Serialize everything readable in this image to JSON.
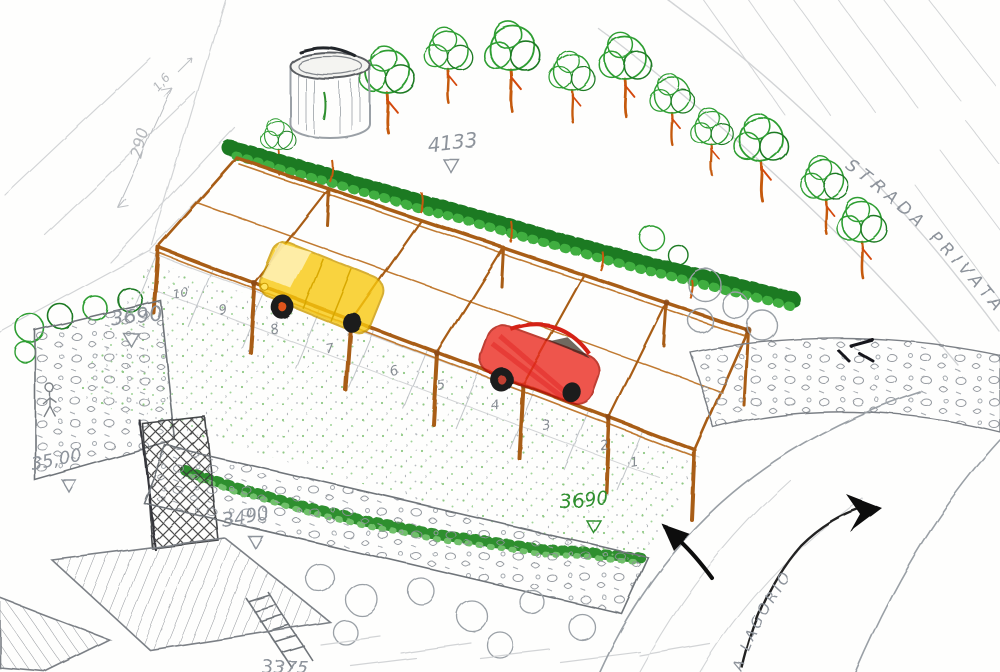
{
  "roads": {
    "strada_privata": "STRADA PRIVATA",
    "via_lagorio": "A LAGORIO"
  },
  "elevations": {
    "orchard": "4133",
    "terrace_upper": "3690",
    "wall_left": "35,00",
    "terrace_lower": "3490",
    "lawn_green": "3690",
    "bottom_partial": "3375"
  },
  "dimensions": {
    "slope_height": "290",
    "slope_offset": "1,6"
  },
  "parking_spaces": {
    "numbers": [
      "10",
      "9",
      "8",
      "7",
      "6",
      "5",
      "4",
      "3",
      "2",
      "1"
    ]
  },
  "colors": {
    "paper": "#fefefd",
    "pencil": "#9aa0a6",
    "pergola_wood": "#a85d16",
    "car_yellow": "#f6c81a",
    "car_red": "#e0251b",
    "foliage_green": "#2f9e33",
    "hedge_green": "#1d7a24",
    "trunk_orange": "#c55a11",
    "ink_black": "#1b1b1b"
  }
}
